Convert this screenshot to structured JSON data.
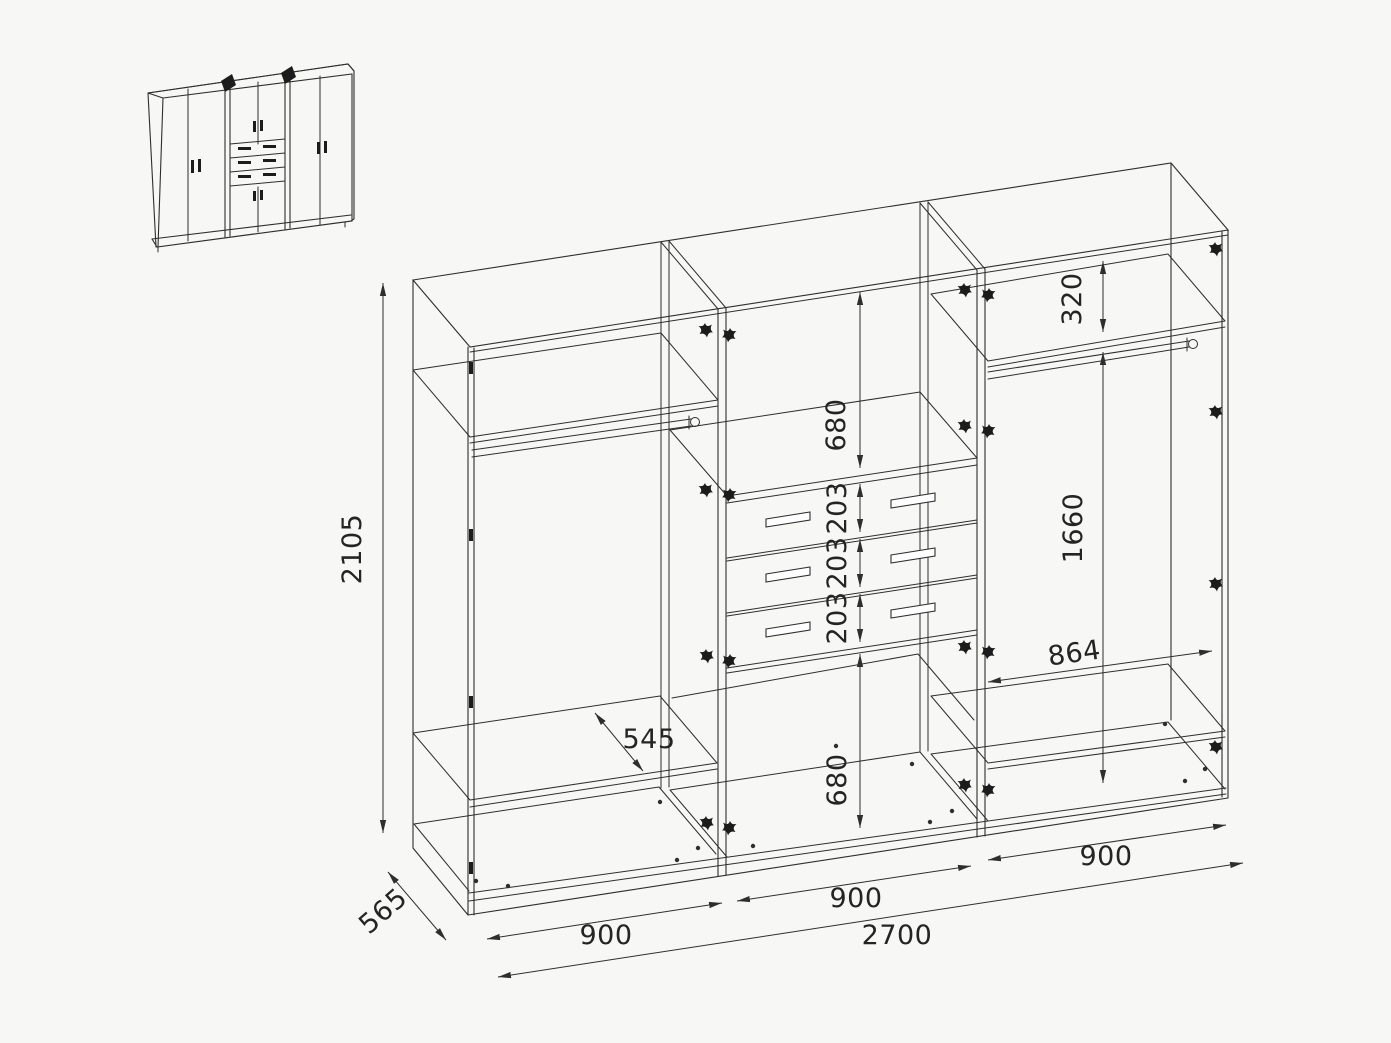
{
  "drawing": {
    "kind": "wardrobe technical drawing",
    "background": "#f7f7f5",
    "line_color": "#2e2e2e",
    "thumbnail": "closed wardrobe front view with six doors and three central drawers"
  },
  "dims": {
    "height": "2105",
    "depth": "565",
    "bay_left": "900",
    "bay_middle": "900",
    "bay_right": "900",
    "total_width": "2700",
    "shelf_depth": "545",
    "middle_upper_space": "680",
    "middle_lower_space": "680",
    "drawer_1": "203",
    "drawer_2": "203",
    "drawer_3": "203",
    "right_top_space": "320",
    "right_hanging_height": "1660",
    "right_inner_width": "864"
  }
}
